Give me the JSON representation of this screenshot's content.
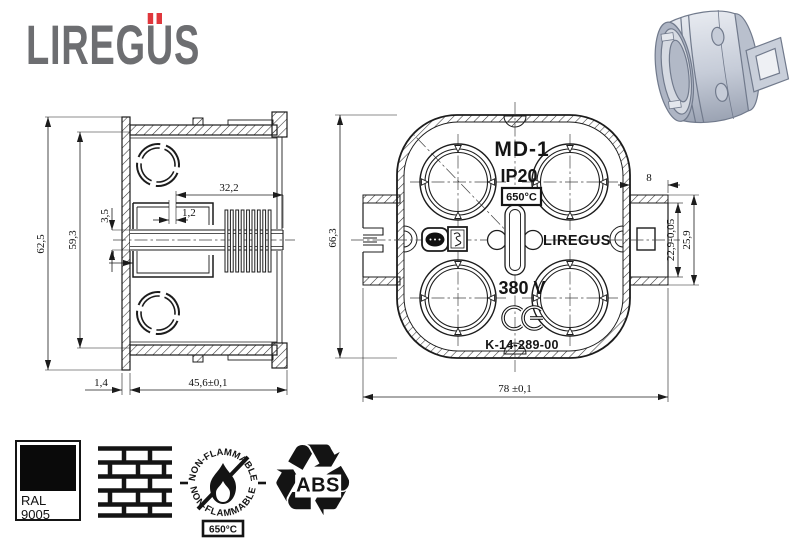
{
  "colors": {
    "logo_gray": "#6d6e71",
    "accent_red": "#e0373c",
    "drawing_line": "#1c1c1c",
    "render_body": "#ccd2dd"
  },
  "brand": {
    "logo_part1": "LIREG",
    "logo_letter_u": "U",
    "logo_part2": "S"
  },
  "side_view": {
    "dims": {
      "outer_height": "62,5",
      "inner_height": "59,3",
      "channel_height": "3,5",
      "slot_width": "1,2",
      "inner_depth": "32,2",
      "wall": "1",
      "flange": "1,4",
      "total_depth": "45,6±0,1"
    }
  },
  "front_view": {
    "model": "MD-1",
    "ip_rating": "IP20",
    "temp_rating": "650°C",
    "brand": "LIREGUS",
    "voltage": "380 V",
    "part_number": "K-14-289-00",
    "dims": {
      "height": "66,3",
      "width": "78 ±0,1",
      "tab_width": "8",
      "tab_inner": "22,9-0,05",
      "tab_outer": "25,9"
    }
  },
  "badges": {
    "ral": {
      "line1": "RAL",
      "line2": "9005"
    },
    "non_flammable": {
      "arc_top": "NON-FLAMMABLE",
      "arc_bottom": "NON-FLAMMABLE",
      "temp": "650°C"
    },
    "abs": {
      "label": "ABS"
    }
  }
}
